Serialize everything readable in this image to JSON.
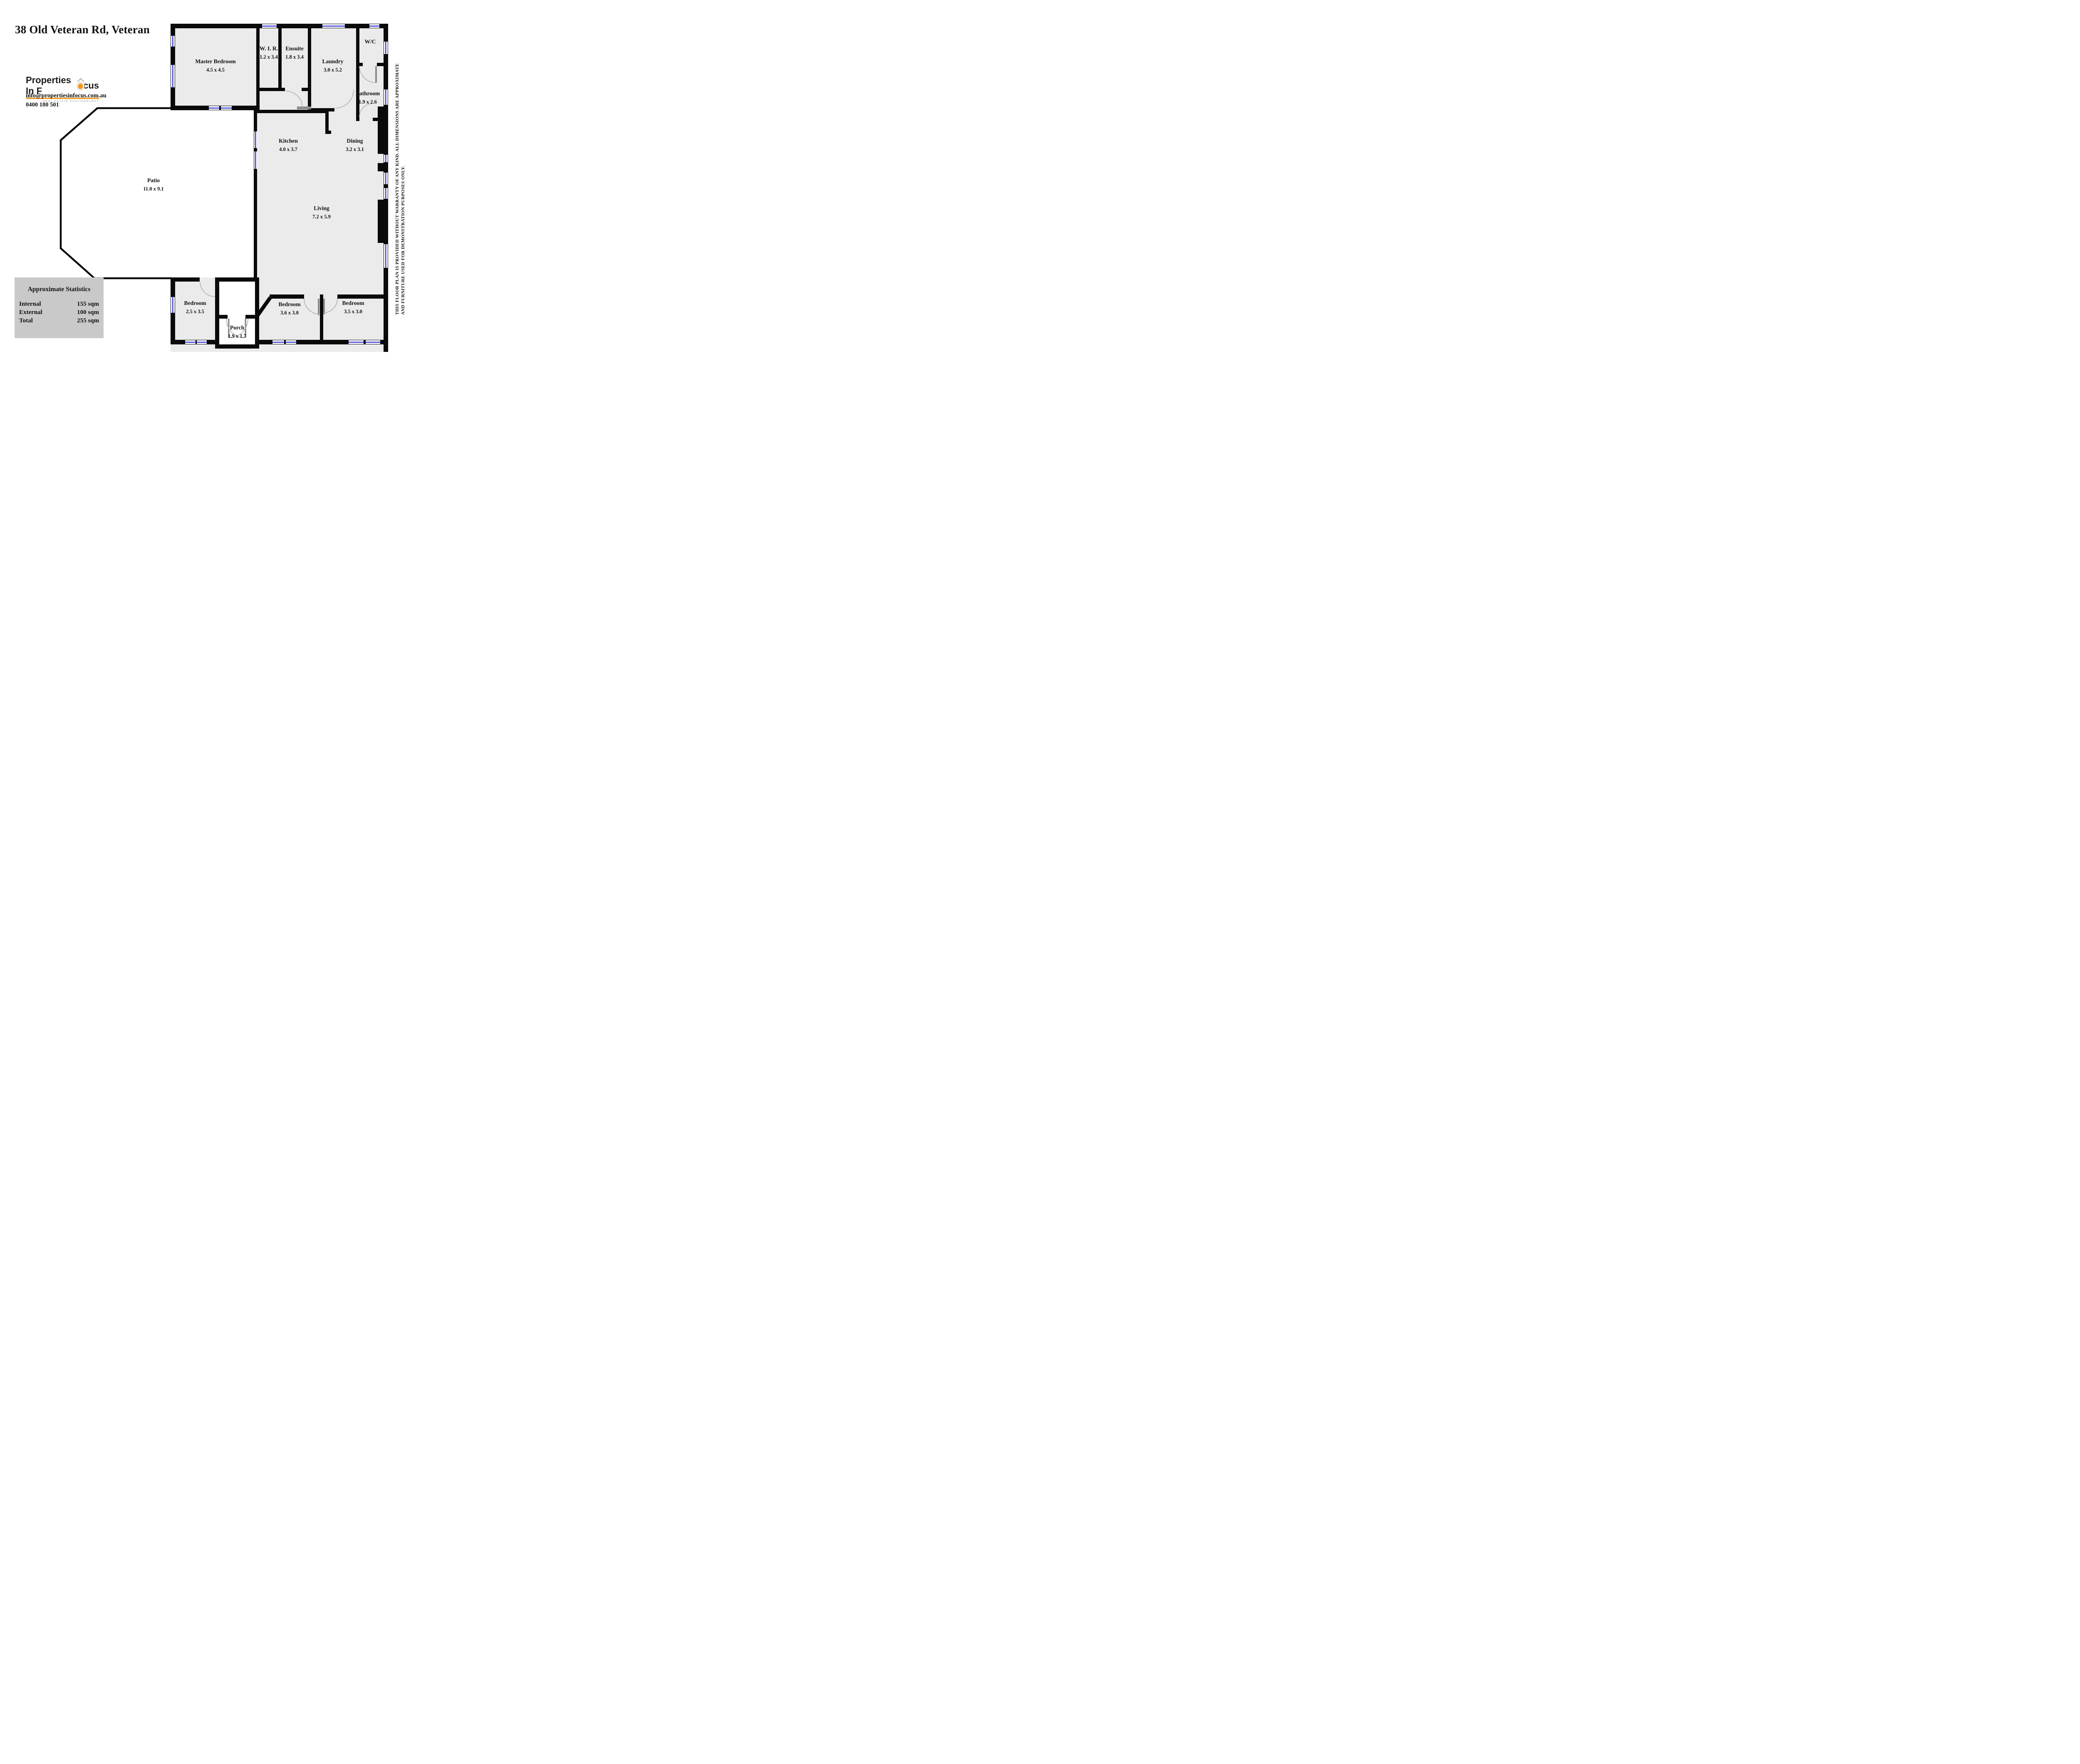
{
  "title": "38 Old Veteran Rd, Veteran",
  "branding": {
    "logo_text_pre": "Properties In F",
    "logo_text_post": "cus",
    "tagline": "REAL ESTATE PHOTOGRAPHY",
    "email": "info@propertiesinfocus.com.au",
    "phone": "0400 180 501"
  },
  "rooms": [
    {
      "name": "Master Bedroom",
      "dims": "4.5 x 4.5"
    },
    {
      "name": "W. I. R.",
      "dims": "1.2 x 3.4"
    },
    {
      "name": "Ensuite",
      "dims": "1.8 x 3.4"
    },
    {
      "name": "Laundry",
      "dims": "3.0 x 5.2"
    },
    {
      "name": "W/C",
      "dims": ""
    },
    {
      "name": "Bathroom",
      "dims": "1.9 x 2.6"
    },
    {
      "name": "Kitchen",
      "dims": "4.0 x 3.7"
    },
    {
      "name": "Dining",
      "dims": "3.2 x 3.1"
    },
    {
      "name": "Patio",
      "dims": "11.0 x 9.1"
    },
    {
      "name": "Living",
      "dims": "7.2 x 5.9"
    },
    {
      "name": "Bedroom",
      "dims": "2.5 x 3.5"
    },
    {
      "name": "Bedroom",
      "dims": "3.6 x 3.0"
    },
    {
      "name": "Bedroom",
      "dims": "3.5 x 3.0"
    },
    {
      "name": "Porch",
      "dims": "1.9 x 1.7"
    }
  ],
  "stats": {
    "title": "Approximate Statistics",
    "rows": [
      {
        "label": "Internal",
        "value": "155 sqm"
      },
      {
        "label": "External",
        "value": "100 sqm"
      },
      {
        "label": "Total",
        "value": "255 sqm"
      }
    ]
  },
  "disclaimer": {
    "line1": "THIS FLOOR PLAN IS PROVIDED WITHOUT WARRANTY OF ANY KIND. ALL DIMENSIONS ARE APPROXIMATE",
    "line2": "AND FURNITURE USED FOR DEMONSTRATION PURPOSES ONLY."
  },
  "colors": {
    "wall": "#0a0a0a",
    "room_fill": "#ebebeb",
    "window_blue": "#4040e0",
    "stats_bg": "#c9c9c9",
    "brand_orange": "#f2991d"
  }
}
